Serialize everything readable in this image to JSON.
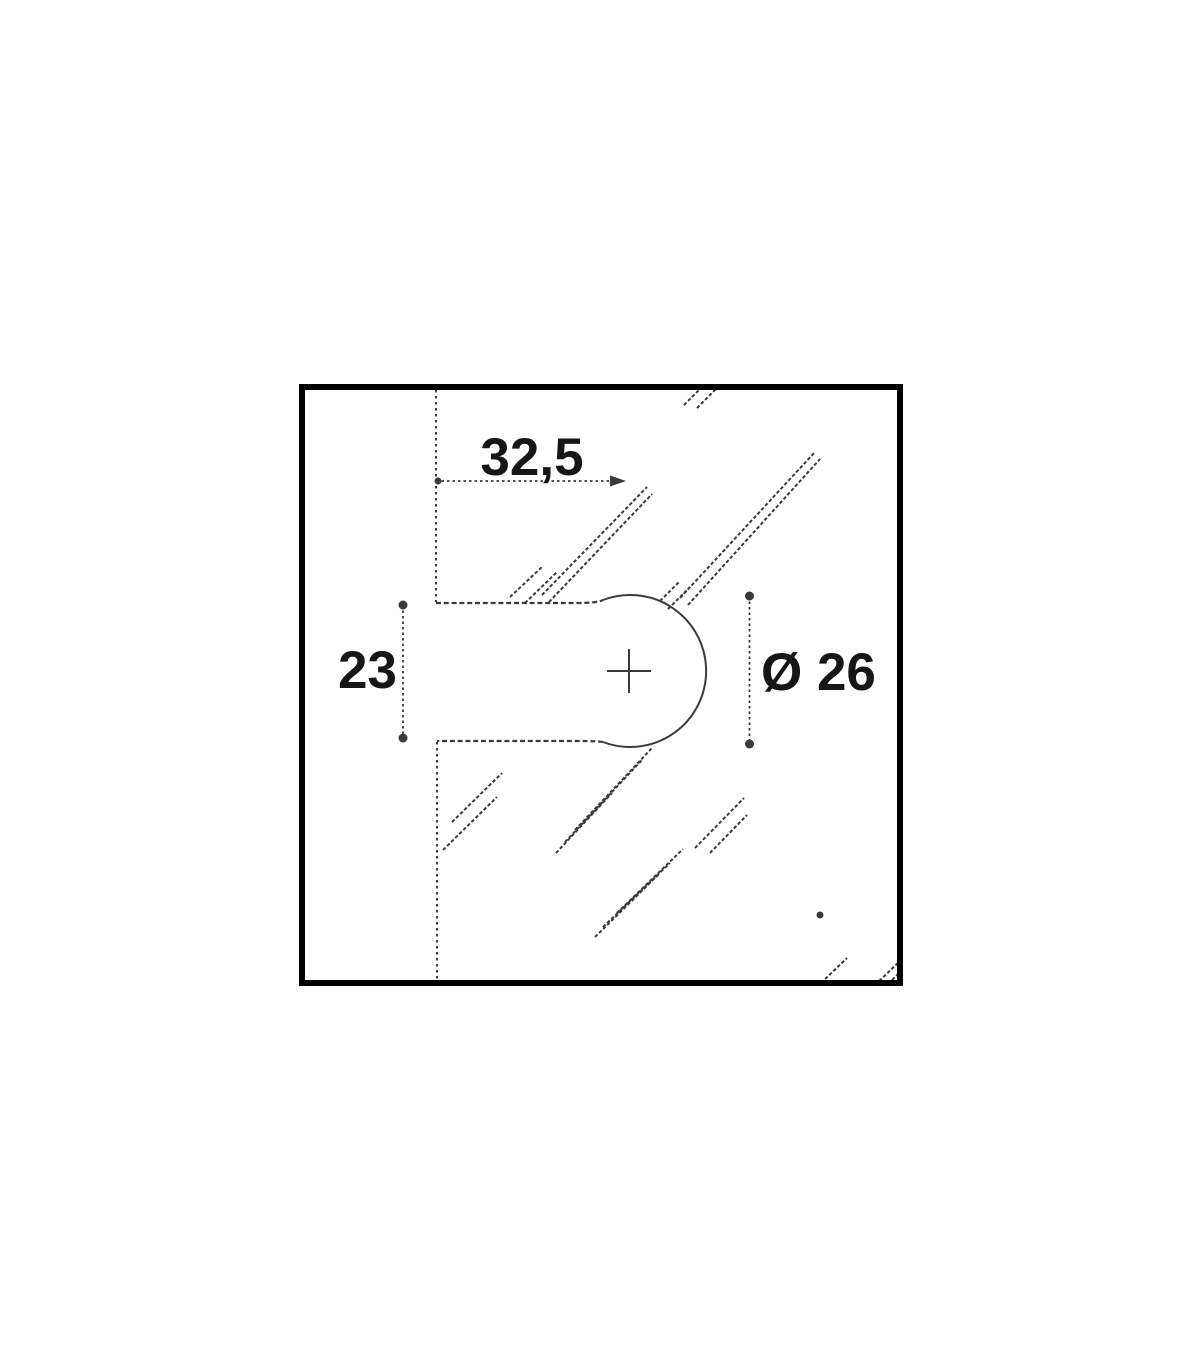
{
  "drawing": {
    "title": "glass cutout dimension diagram",
    "labels": {
      "width": "32,5",
      "slot": "23",
      "diameter": "Ø 26"
    },
    "colors": {
      "frame": "#000000",
      "line": "#3a3a3a",
      "text": "#161616",
      "background": "#ffffff"
    }
  }
}
